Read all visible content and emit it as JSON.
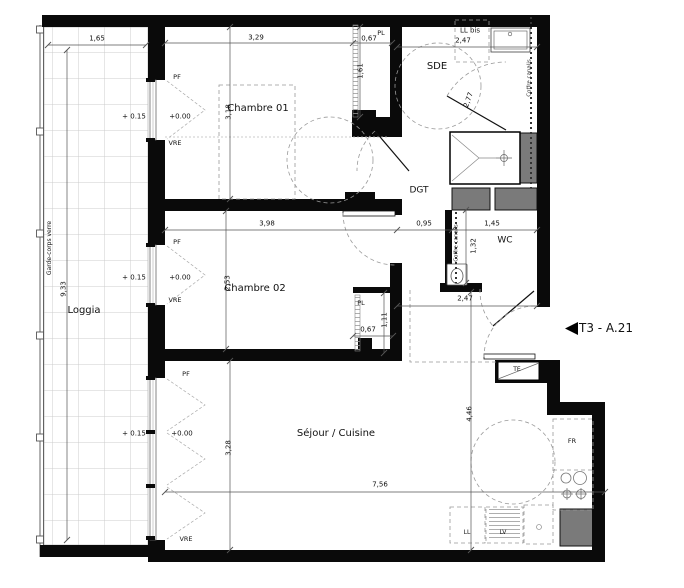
{
  "plan": {
    "unit_label": "T3 - A.21",
    "rooms": {
      "loggia": "Loggia",
      "chambre01": "Chambre 01",
      "chambre02": "Chambre 02",
      "sejour": "Séjour / Cuisine",
      "sde": "SDE",
      "dgt": "DGT",
      "wc": "WC"
    },
    "levels": {
      "loggia": "+ 0.15",
      "interior": "+0.00"
    },
    "annotations": {
      "garde_corps": "Garde-corps verre",
      "coffre": "Coffre canalis",
      "ll_bis": "LL bis",
      "pf": "PF",
      "vre": "VRE",
      "pl": "PL",
      "te": "TE",
      "fr": "FR",
      "ll": "LL",
      "lv": "LV"
    },
    "dims": {
      "loggia_w": "1,65",
      "loggia_h": "9,33",
      "ch1_w": "3,29",
      "ch1_h": "3,18",
      "pl1_w": "0,67",
      "pl1_h": "1,61",
      "sde_w": "2,47",
      "sde_h": "2,77",
      "ch2_w": "3,98",
      "ch2_h": "2,53",
      "pl2_w": "0,67",
      "pl2_h": "1,11",
      "dgt_w": "0,95",
      "wc_w": "1,45",
      "wc_h": "1,32",
      "entry_w": "2,47",
      "sejour_w": "7,56",
      "sejour_h_left": "3,28",
      "sejour_h_right": "4,46"
    },
    "colors": {
      "wall": "#0a0a0a",
      "duct": "#7a7a7a",
      "line": "#444444"
    },
    "icons": {
      "unit_pointer": "left-triangle"
    }
  }
}
